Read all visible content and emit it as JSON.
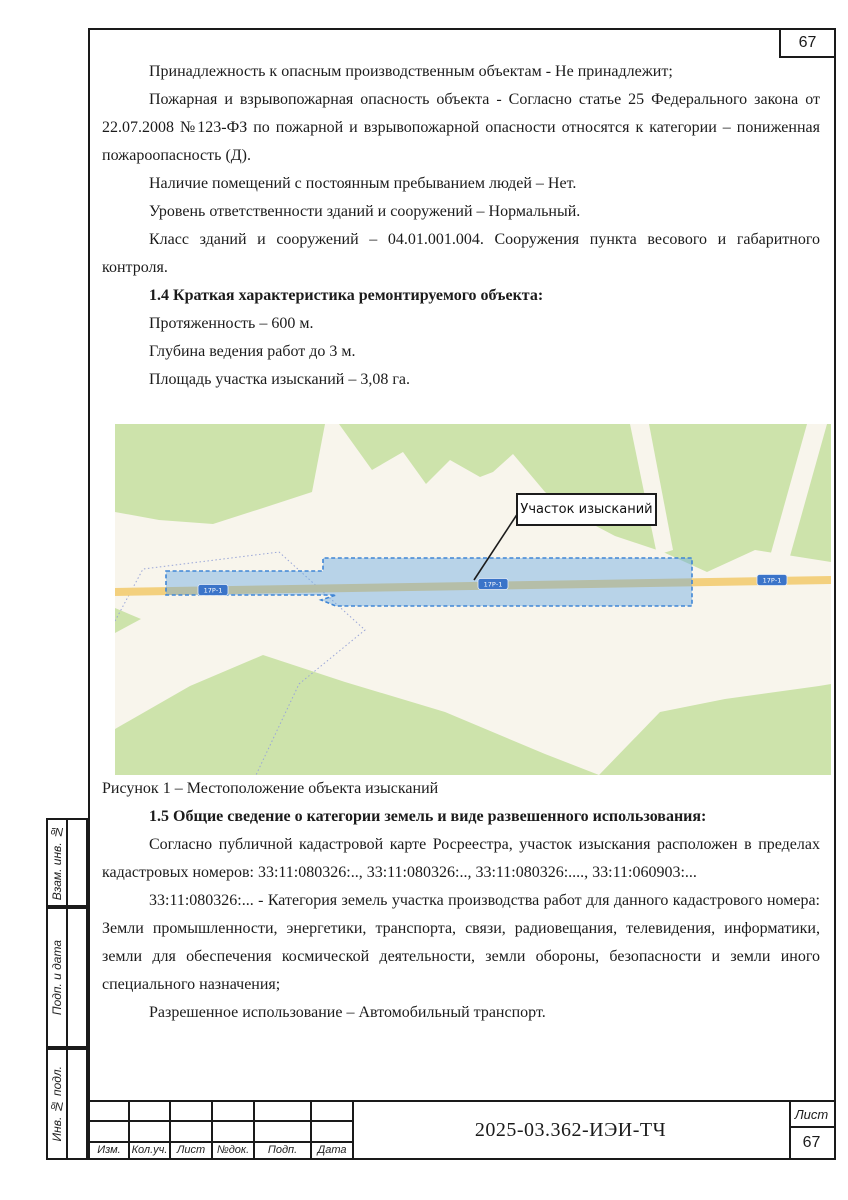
{
  "page": {
    "corner_page_number": "67"
  },
  "content": {
    "p1": "Принадлежность к опасным производственным объектам - Не принадлежит;",
    "p2": "Пожарная и взрывопожарная опасность объекта - Согласно статье 25 Федерального закона от 22.07.2008 №123-ФЗ по пожарной и взрывопожарной опасности относятся к категории – пониженная пожароопасность (Д).",
    "p3": "Наличие помещений с постоянным пребыванием людей – Нет.",
    "p4": "Уровень ответственности зданий и сооружений – Нормальный.",
    "p5": "Класс зданий и сооружений – 04.01.001.004. Сооружения пункта весового и габаритного контроля.",
    "h14": "1.4 Краткая характеристика ремонтируемого объекта:",
    "p6": "Протяженность – 600 м.",
    "p7": "Глубина ведения работ до 3 м.",
    "p8": "Площадь участка изысканий – 3,08 га.",
    "figure_caption": "Рисунок 1 – Местоположение объекта изысканий",
    "h15": "1.5 Общие сведение о категории земель и виде развешенного использования:",
    "p9": "Согласно публичной кадастровой карте Росреестра, участок изыскания расположен в пределах кадастровых номеров: 33:11:080326:.., 33:11:080326:.., 33:11:080326:...., 33:11:060903:...",
    "p10": "33:11:080326:... - Категория земель участка производства работ для данного кадастрового номера: Земли промышленности, энергетики, транспорта, связи, радиовещания, телевидения, информатики, земли для обеспечения космической деятельности, земли обороны, безопасности и земли иного специального назначения;",
    "p11": "Разрешенное использование – Автомобильный транспорт."
  },
  "map": {
    "label_box": "Участок изысканий",
    "road_badge": "17Р-1",
    "colors": {
      "background": "#f8f5ec",
      "greenery": "#cde3ab",
      "road": "#f3d07e",
      "survey_area_fill": "#b8d3e8",
      "survey_area_border": "#3f86d6",
      "road_badge": "#3b74c9"
    }
  },
  "sidebar": {
    "items": [
      {
        "label": "Взам. инв. №"
      },
      {
        "label": "Подп. и дата"
      },
      {
        "label": "Инв. № подл."
      }
    ]
  },
  "title_block": {
    "columns": [
      "Изм.",
      "Кол.уч.",
      "Лист",
      "№док.",
      "Подп.",
      "Дата"
    ],
    "doc_code": "2025-03.362-ИЭИ-ТЧ",
    "sheet_label": "Лист",
    "sheet_number": "67"
  }
}
